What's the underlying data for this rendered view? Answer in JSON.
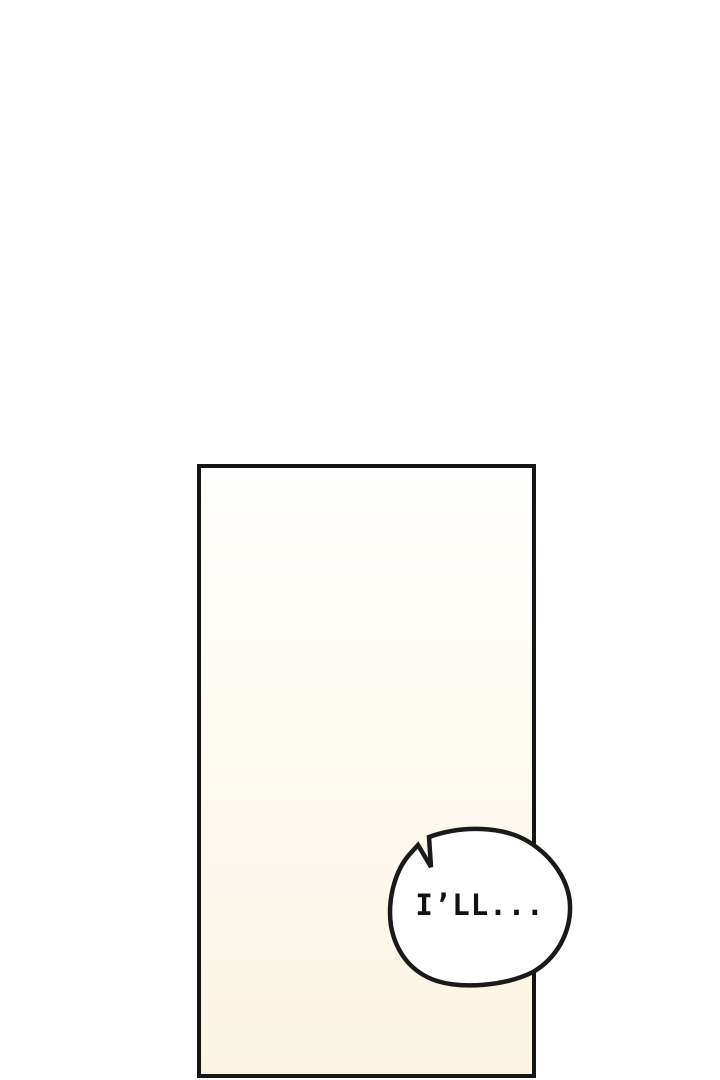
{
  "page": {
    "background_color": "#ffffff"
  },
  "comic": {
    "panel": {
      "border_color": "#151515",
      "fill_top": "#fefefc",
      "fill_mid": "#fdfaf1",
      "fill_bottom": "#faf3e1"
    },
    "speech_bubble": {
      "text": "I’LL...",
      "fill": "#ffffff",
      "stroke": "#1a1a1a",
      "text_color": "#121212"
    }
  }
}
